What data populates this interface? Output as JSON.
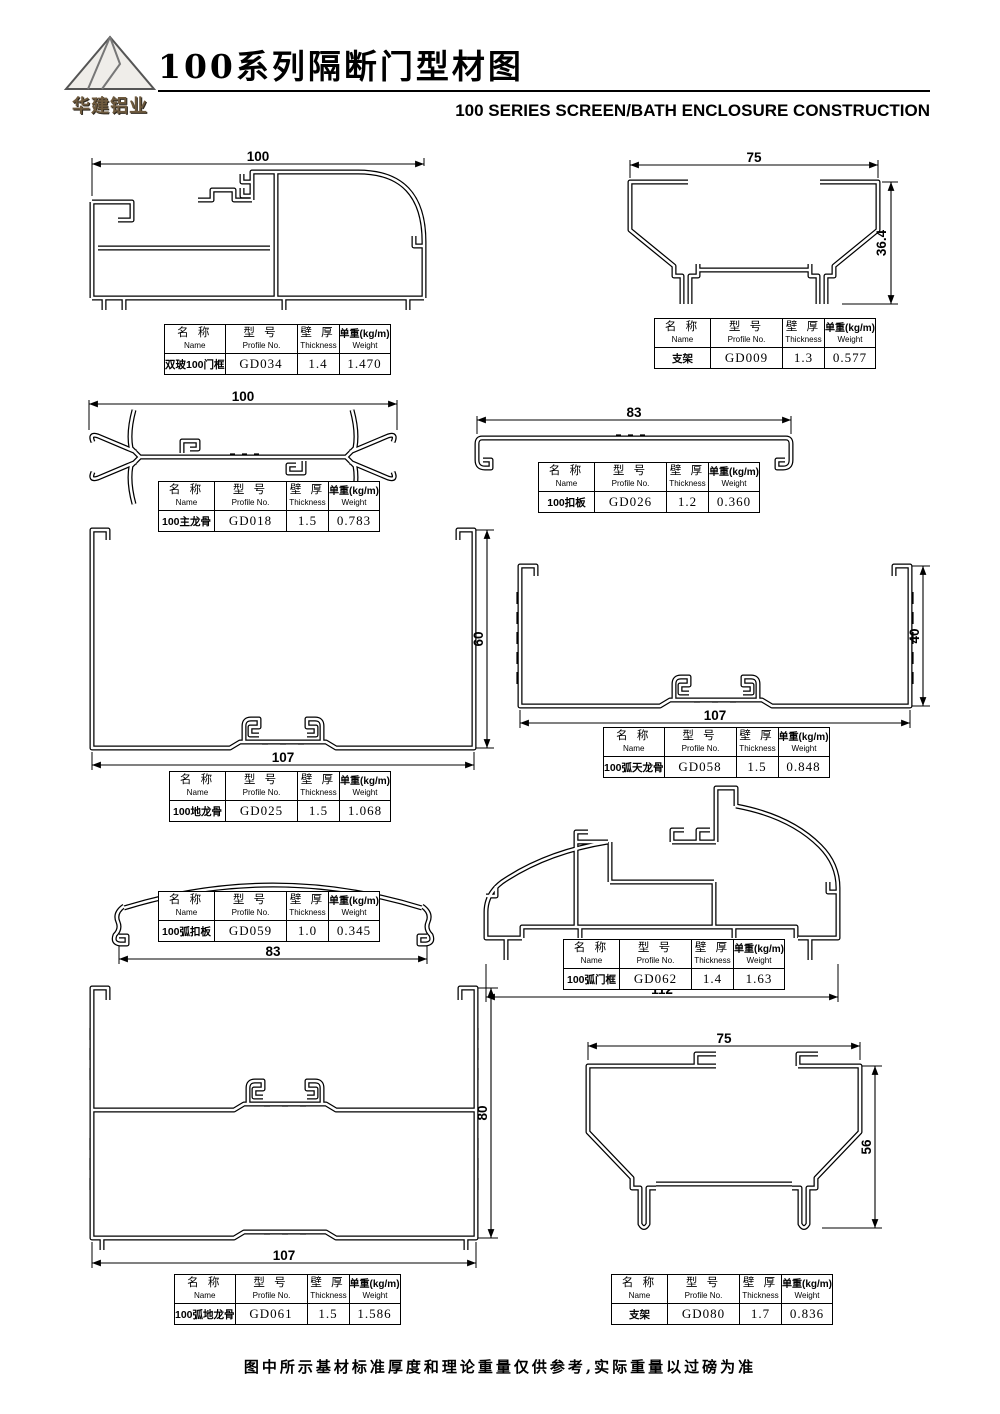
{
  "header": {
    "logo_text": "华建铝业",
    "title": "100系列隔断门型材图",
    "subtitle": "100 SERIES SCREEN/BATH ENCLOSURE CONSTRUCTION"
  },
  "table_headers": {
    "name_cn": "名 称",
    "name_en": "Name",
    "model_cn": "型 号",
    "model_en": "Profile No.",
    "thickness_cn": "壁 厚",
    "thickness_en": "Thickness",
    "weight_cn": "单重(kg/m)",
    "weight_en": "Weight"
  },
  "profiles": [
    {
      "name": "双玻100门框",
      "model": "GD034",
      "thickness": "1.4",
      "weight": "1.470",
      "dims": {
        "width": "100"
      }
    },
    {
      "name": "支架",
      "model": "GD009",
      "thickness": "1.3",
      "weight": "0.577",
      "dims": {
        "width": "75",
        "height": "36.4"
      }
    },
    {
      "name": "100主龙骨",
      "model": "GD018",
      "thickness": "1.5",
      "weight": "0.783",
      "dims": {
        "width": "100"
      }
    },
    {
      "name": "100扣板",
      "model": "GD026",
      "thickness": "1.2",
      "weight": "0.360",
      "dims": {
        "width": "83"
      }
    },
    {
      "name": "100地龙骨",
      "model": "GD025",
      "thickness": "1.5",
      "weight": "1.068",
      "dims": {
        "width": "107",
        "height": "60"
      }
    },
    {
      "name": "100弧天龙骨",
      "model": "GD058",
      "thickness": "1.5",
      "weight": "0.848",
      "dims": {
        "width": "107",
        "height": "40"
      }
    },
    {
      "name": "100弧扣板",
      "model": "GD059",
      "thickness": "1.0",
      "weight": "0.345",
      "dims": {
        "width": "83"
      }
    },
    {
      "name": "100弧门框",
      "model": "GD062",
      "thickness": "1.4",
      "weight": "1.63",
      "dims": {
        "width": "112"
      }
    },
    {
      "name": "100弧地龙骨",
      "model": "GD061",
      "thickness": "1.5",
      "weight": "1.586",
      "dims": {
        "width": "107",
        "height": "80"
      }
    },
    {
      "name": "支架",
      "model": "GD080",
      "thickness": "1.7",
      "weight": "0.836",
      "dims": {
        "width": "75",
        "height": "56"
      }
    }
  ],
  "footer": {
    "note": "图中所示基材标准厚度和理论重量仅供参考,实际重量以过磅为准"
  },
  "colors": {
    "line": "#000000",
    "background": "#ffffff",
    "logo_text": "#6e5a3e"
  }
}
